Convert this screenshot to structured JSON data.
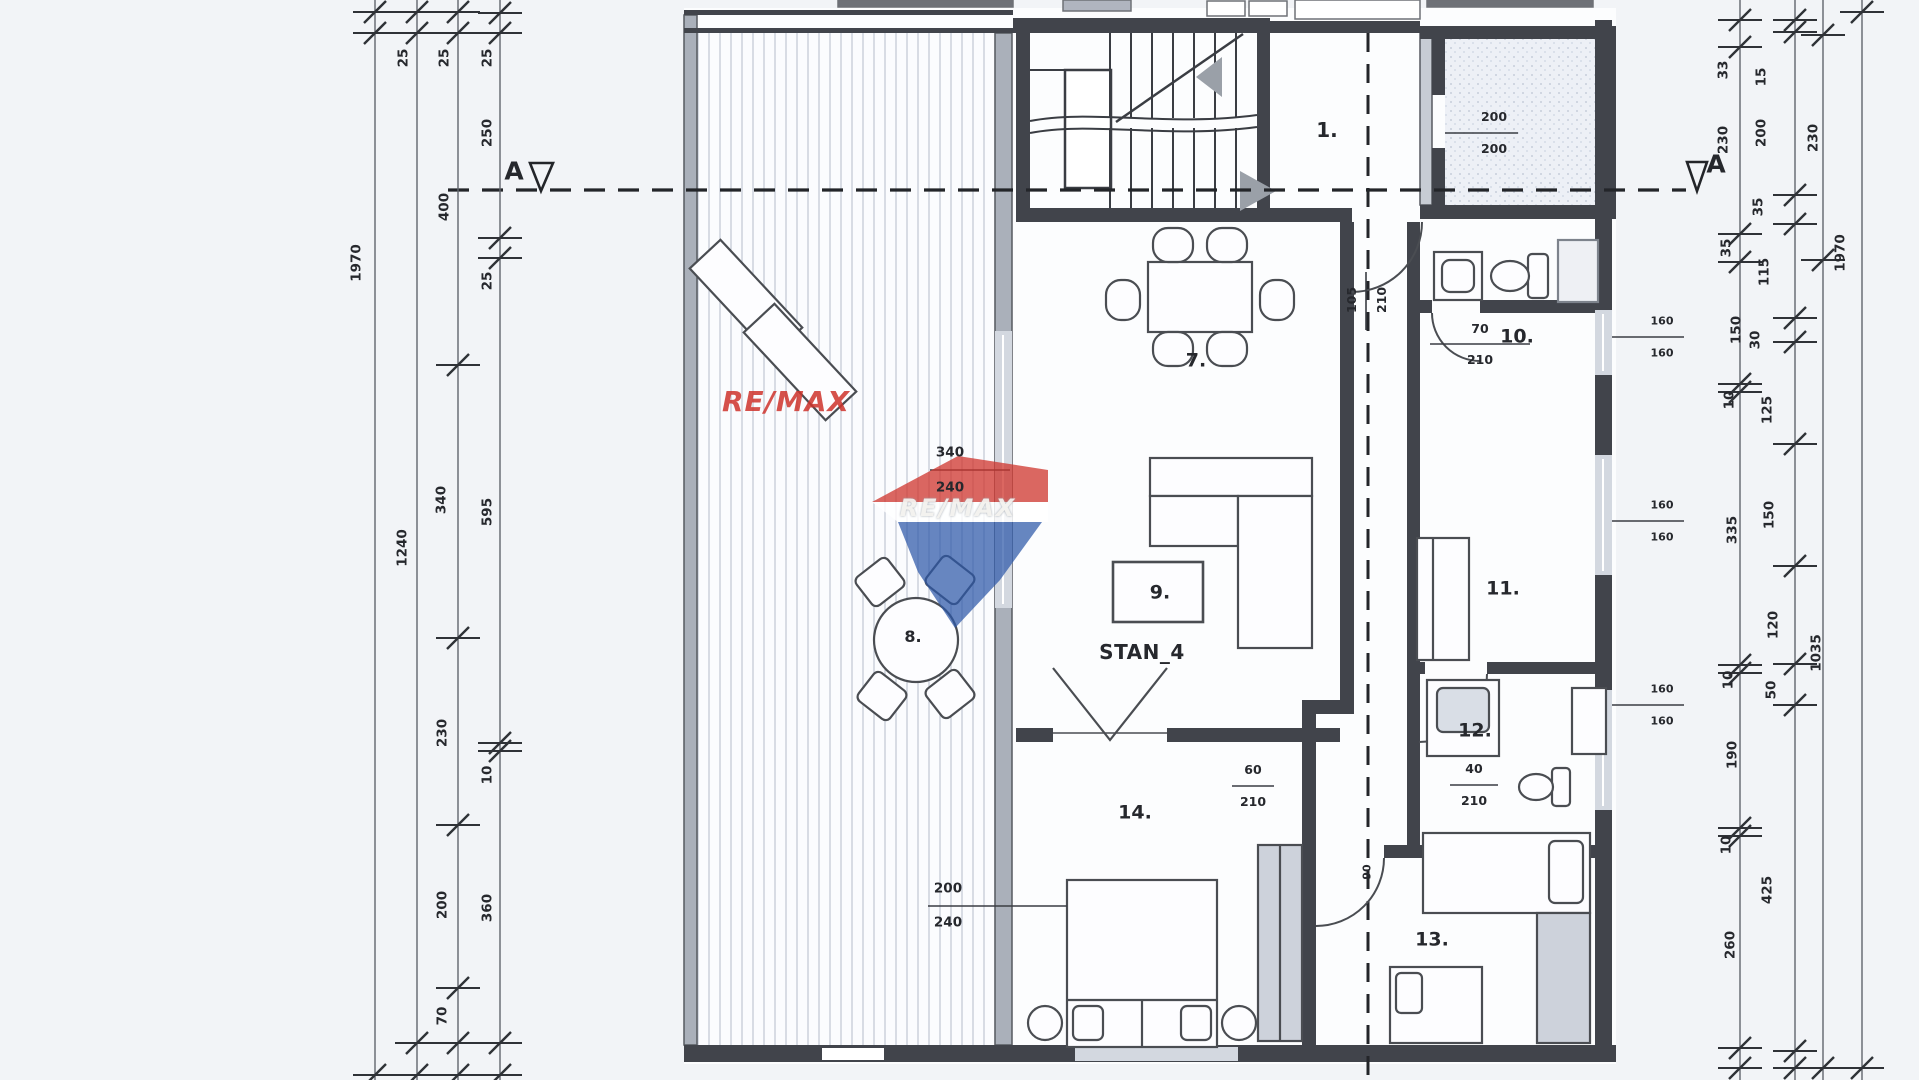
{
  "apartment_label": "STAN_4",
  "section": {
    "left": "A",
    "right": "A"
  },
  "rooms": {
    "r1": "1.",
    "r7": "7.",
    "r8": "8.",
    "r9": "9.",
    "r10": "10.",
    "r11": "11.",
    "r12": "12.",
    "r13": "13.",
    "r14": "14."
  },
  "openings": {
    "entry": {
      "w": "105",
      "h": "210"
    },
    "wc_door": {
      "w": "70",
      "h": "210"
    },
    "hall_door": {
      "w": "60",
      "h": "210"
    },
    "bath_door": {
      "w": "40",
      "h": "210"
    },
    "bedroom13_door": {
      "w": "90"
    },
    "elevator": {
      "a": "200",
      "b": "200"
    },
    "living_window": {
      "w": "340",
      "h": "240"
    },
    "bedroom14_window": {
      "w": "200",
      "h": "240"
    },
    "win_right_1": {
      "a": "160",
      "b": "160"
    },
    "win_right_2": {
      "a": "160",
      "b": "160"
    },
    "win_right_3": {
      "a": "160",
      "b": "160"
    }
  },
  "dims_left": {
    "total": "1970",
    "subtotal": "1240",
    "w1": "25",
    "w2": "25",
    "w3": "25",
    "c1": "250",
    "c2": "400",
    "c3": "25",
    "c4": "340",
    "c5": "595",
    "c6": "230",
    "c7": "10",
    "c8": "200",
    "c9": "360",
    "c10": "70"
  },
  "dims_right": {
    "total": "1970",
    "subtotal_top": "230",
    "subtotal_mid": "1035",
    "a1": "33",
    "a2": "230",
    "a3": "35",
    "a4": "150",
    "a5": "10",
    "a6": "335",
    "a7": "10",
    "a8": "190",
    "a9": "10",
    "a10": "260",
    "b1": "15",
    "b2": "200",
    "b3": "35",
    "b4": "115",
    "b5": "30",
    "b6": "125",
    "b7": "150",
    "b8": "120",
    "b9": "50",
    "b10": "425"
  },
  "watermark": {
    "wordmark": "RE/MAX",
    "balloon_text": "RE/MAX",
    "red": "#cf342c",
    "blue": "#2c57a7"
  },
  "colors": {
    "wall": "#41444b",
    "gray_wall": "#aab0ba",
    "hatch": "#c6ccd7",
    "paper": "#f2f4f7"
  }
}
